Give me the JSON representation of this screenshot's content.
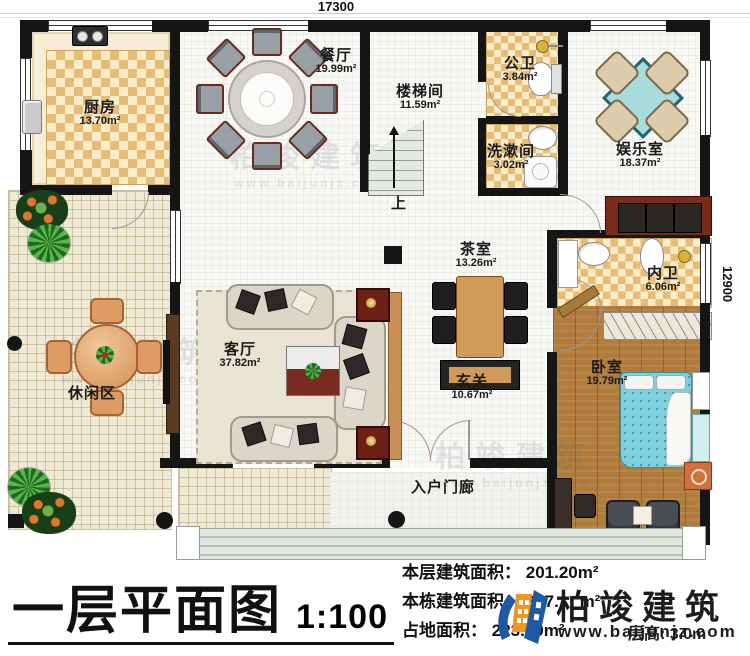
{
  "dimensions": {
    "width_top": "17300",
    "height_right": "12900"
  },
  "rooms": {
    "kitchen": {
      "name": "厨房",
      "area": "13.70m²"
    },
    "dining": {
      "name": "餐厅",
      "area": "19.99m²"
    },
    "stairwell": {
      "name": "楼梯间",
      "area": "11.59m²"
    },
    "public_bathroom": {
      "name": "公卫",
      "area": "3.84m²"
    },
    "washroom": {
      "name": "洗漱间",
      "area": "3.02m²"
    },
    "entertainment": {
      "name": "娱乐室",
      "area": "18.37m²"
    },
    "tea_room": {
      "name": "茶室",
      "area": "13.26m²"
    },
    "inner_bathroom": {
      "name": "内卫",
      "area": "6.06m²"
    },
    "living_room": {
      "name": "客厅",
      "area": "37.82m²"
    },
    "foyer": {
      "name": "玄关",
      "area": "10.67m²"
    },
    "bedroom": {
      "name": "卧室",
      "area": "19.79m²"
    },
    "leisure": {
      "name": "休闲区"
    },
    "entry_porch": {
      "name": "入户门廊"
    },
    "stairs_up": {
      "name": "上"
    }
  },
  "title": {
    "text": "一层平面图",
    "scale": "1:100"
  },
  "stats": {
    "floor_area_label": "本层建筑面积：",
    "floor_area_value": "201.20m²",
    "total_area_label": "本栋建筑面积：",
    "total_area_value": "387.",
    "total_area_unit": "m²",
    "footprint_label": "占地面积：",
    "footprint_value": "223.79m²",
    "height_note": "层高: 3.0m"
  },
  "logo": {
    "name": "柏竣建筑",
    "website": "www.baijunjz.com"
  },
  "watermark": {
    "name": "柏竣建筑",
    "website": "www.baijunjz.com"
  },
  "colors": {
    "wall": "#151515",
    "checker_tile": "#e7bd75",
    "wood_floor": "#b07c3c",
    "bed": "#7ed0de",
    "logo_blue": "#1e59a5",
    "logo_orange": "#f7941d"
  }
}
